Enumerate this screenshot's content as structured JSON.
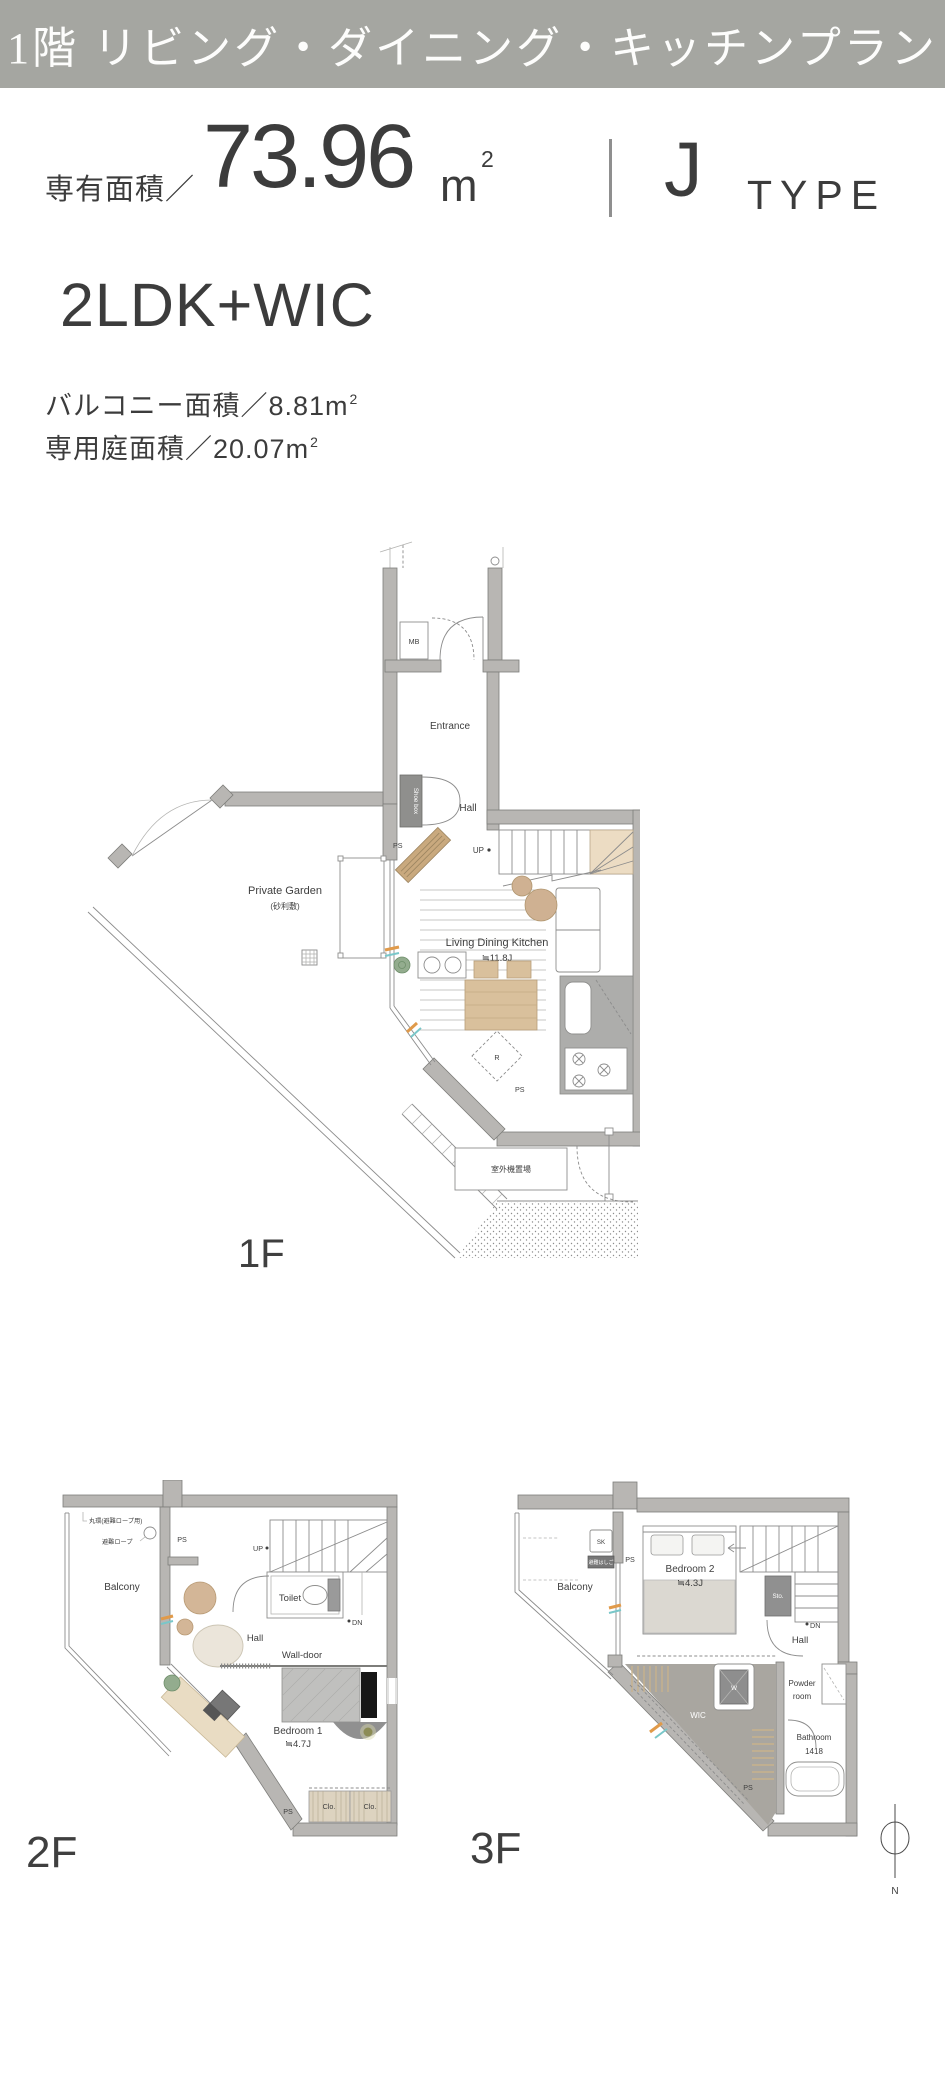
{
  "banner": {
    "title": "1階 リビング・ダイニング・キッチンプラン"
  },
  "summary": {
    "area_label": "専有面積／",
    "area_value": "73.96",
    "area_unit": "m",
    "area_unit_sup": "2",
    "type_value": "J",
    "type_suffix": "TYPE",
    "layout": "2LDK+WIC",
    "details": [
      {
        "label": "バルコニー面積／",
        "value": "8.81",
        "unit": "m",
        "unit_sup": "2"
      },
      {
        "label": "専用庭面積／",
        "value": "20.07",
        "unit": "m",
        "unit_sup": "2"
      }
    ]
  },
  "floors": {
    "f1": {
      "name": "1F",
      "labels": {
        "mb": "MB",
        "entrance": "Entrance",
        "shoe_box": "Shoe box",
        "hall": "Hall",
        "ps_upper": "PS",
        "up": "UP",
        "private_garden": "Private Garden",
        "private_garden_note": "(砂利敷)",
        "ldk": "Living Dining Kitchen",
        "ldk_size": "≒11.8J",
        "fridge": "R",
        "ps_lower": "PS",
        "outdoor_unit": "室外機置場"
      }
    },
    "f2": {
      "name": "2F",
      "labels": {
        "ring": "丸環(避難ロープ用)",
        "rope": "避難ロープ",
        "ps_upper": "PS",
        "balcony": "Balcony",
        "up": "UP",
        "dn": "DN",
        "toilet": "Toilet",
        "hall": "Hall",
        "wall_door": "Wall-door",
        "bedroom": "Bedroom 1",
        "bedroom_size": "≒4.7J",
        "closet1": "Clo.",
        "closet2": "Clo.",
        "ps_lower": "PS"
      }
    },
    "f3": {
      "name": "3F",
      "labels": {
        "sk": "SK",
        "ladder": "避難はしご",
        "ps_upper": "PS",
        "balcony": "Balcony",
        "bedroom": "Bedroom 2",
        "bedroom_size": "≒4.3J",
        "storage": "Sto.",
        "dn": "DN",
        "hall": "Hall",
        "washer": "W",
        "wic": "WIC",
        "powder_line1": "Powder",
        "powder_line2": "room",
        "bathroom": "Bathroom",
        "bathroom_size": "1418",
        "ps_lower": "PS"
      }
    }
  },
  "compass": {
    "north": "N"
  },
  "colors": {
    "banner_bg": "#a5a6a1",
    "text": "#3c3c3c",
    "wall": "#b8b6b3",
    "wood": "#d9c09c",
    "stair_corner": "#ecdcc3",
    "wic_fill": "#a9a6a0",
    "accent_orange": "#e09a4a",
    "accent_teal": "#79c7c9",
    "plant_green": "#93ac8e"
  }
}
